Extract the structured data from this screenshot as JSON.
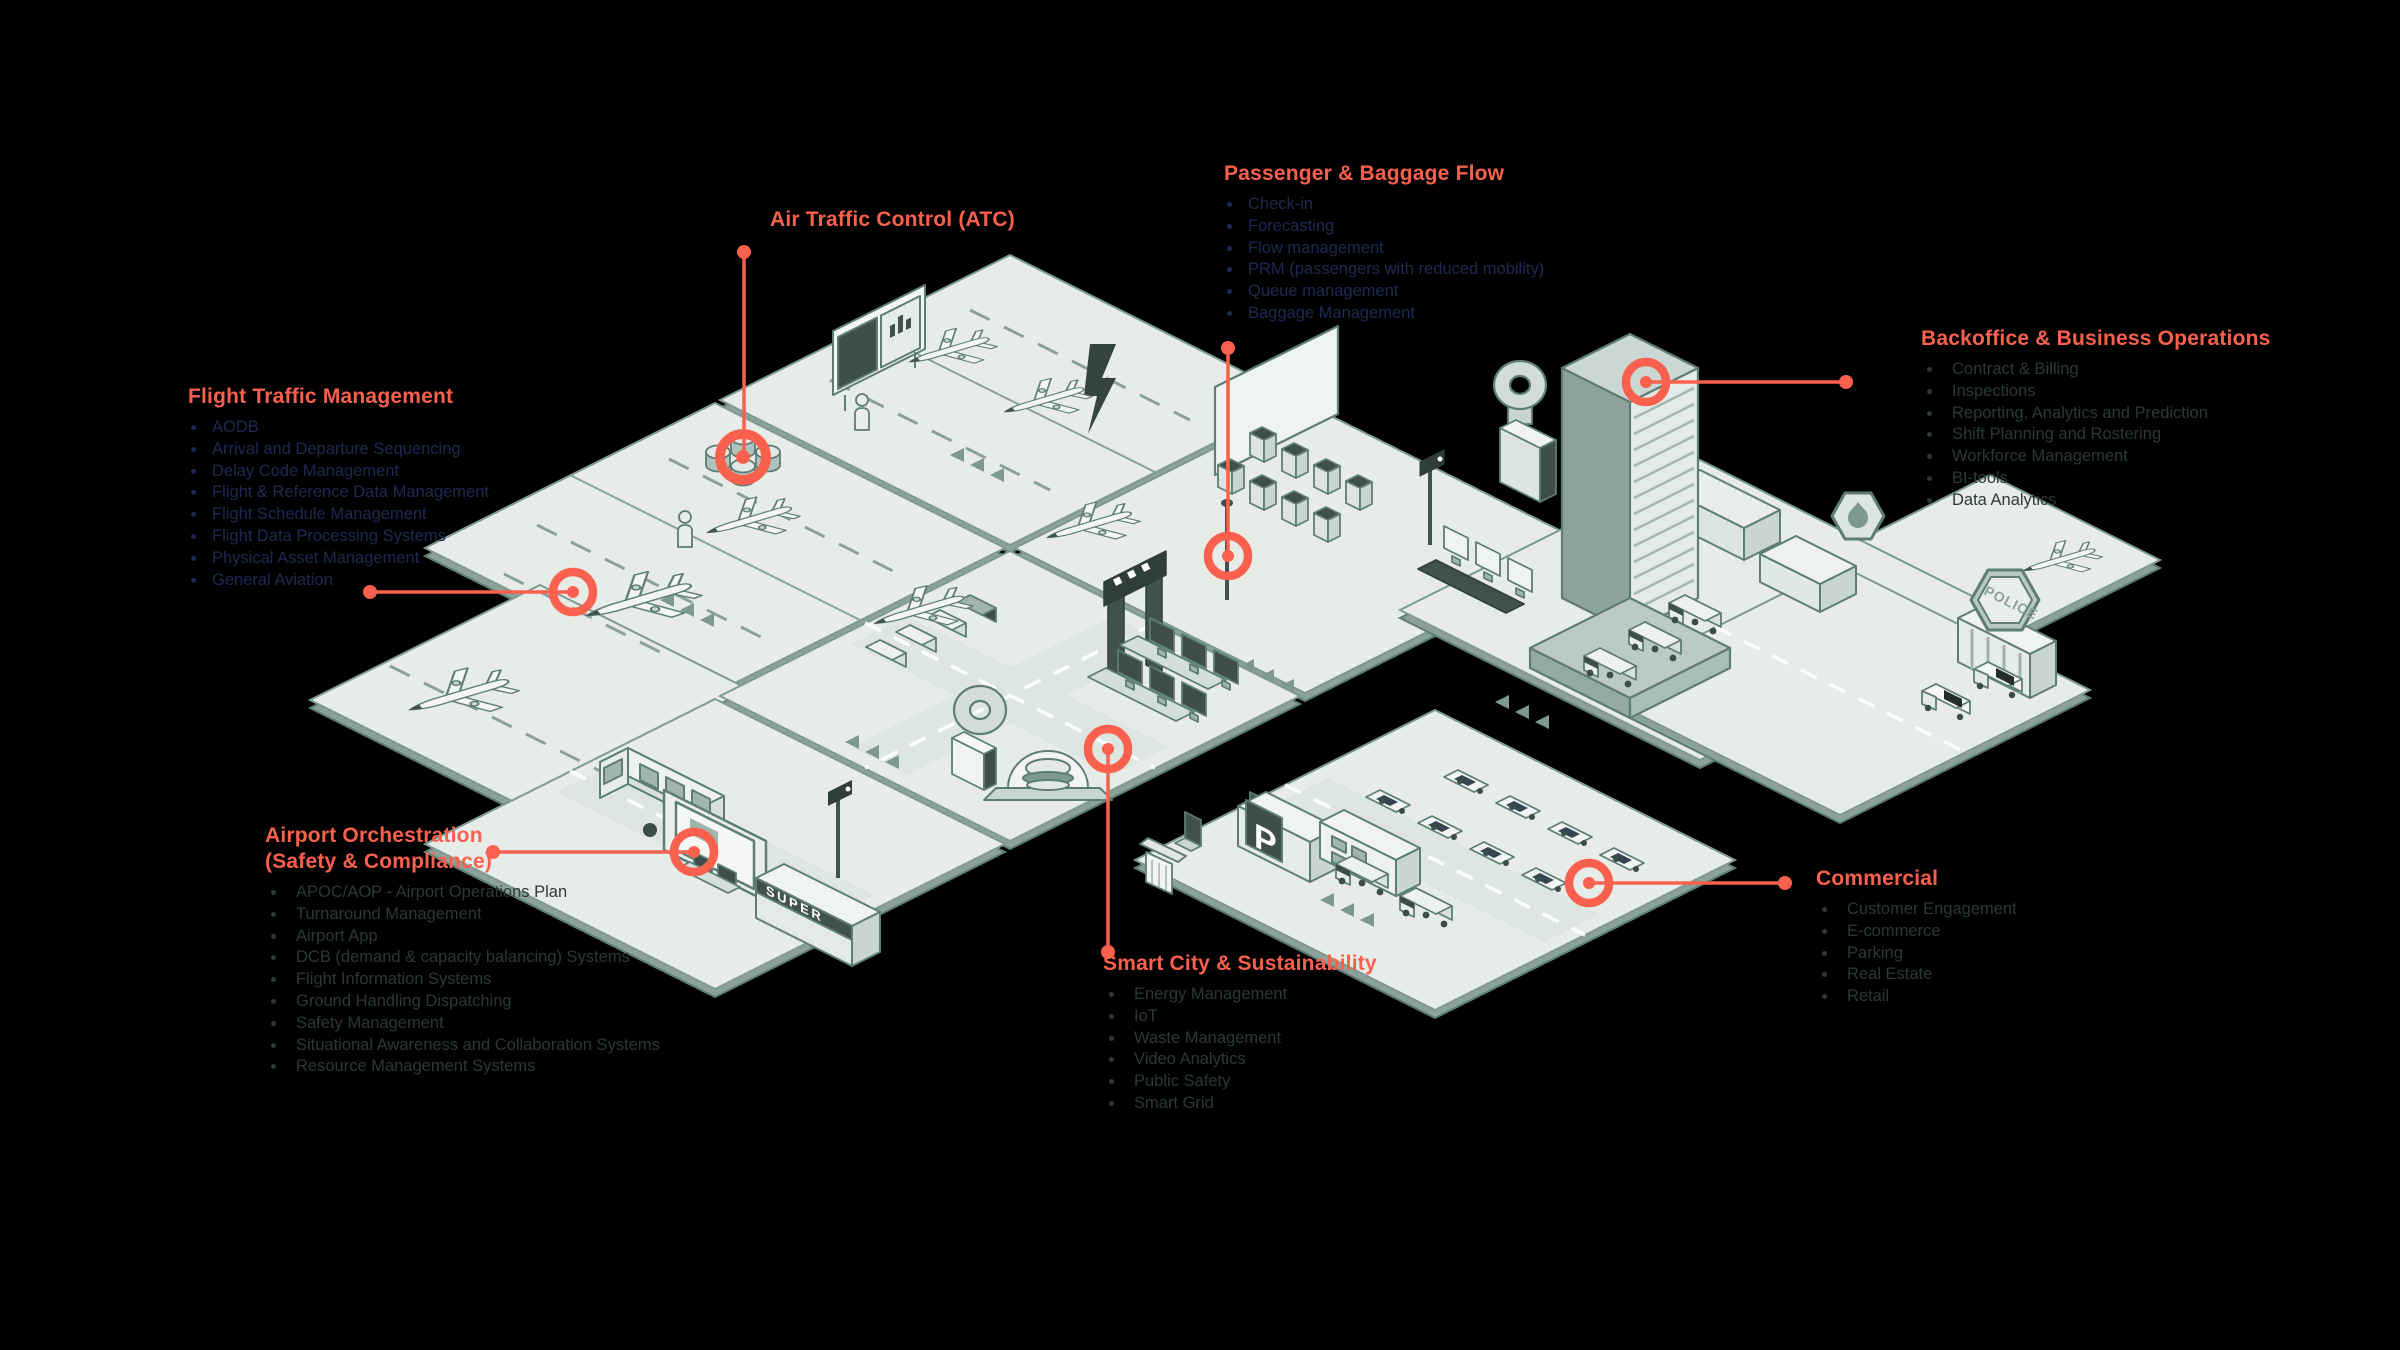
{
  "colors": {
    "accent": "#F9614E",
    "navy": "#1E2A52",
    "slate": "#2C3936"
  },
  "illustration": {
    "super_sign": "SUPER",
    "police_sign": "POLICE",
    "parking_sign": "P"
  },
  "callouts": {
    "flight_traffic_management": {
      "title": "Flight Traffic Management",
      "items": [
        "AODB",
        "Arrival and Departure Sequencing",
        "Delay Code Management",
        "Flight & Reference Data Management",
        "Flight Schedule Management",
        "Flight Data Processing Systems",
        "Physical Asset Management",
        "General Aviation"
      ]
    },
    "air_traffic_control": {
      "title": "Air Traffic Control (ATC)",
      "items": []
    },
    "passenger_baggage_flow": {
      "title": "Passenger & Baggage Flow",
      "items": [
        "Check-in",
        "Forecasting",
        "Flow management",
        "PRM (passengers with reduced mobility)",
        "Queue management",
        "Baggage Management"
      ]
    },
    "backoffice_business_operations": {
      "title": "Backoffice & Business Operations",
      "items": [
        "Contract & Billing",
        "Inspections",
        "Reporting, Analytics and Prediction",
        "Shift Planning and Rostering",
        "Workforce Management",
        "BI-tools",
        "Data Analytics"
      ]
    },
    "airport_orchestration": {
      "title": "Airport Orchestration\n(Safety & Compliance)",
      "items": [
        "APOC/AOP - Airport Operations Plan",
        "Turnaround Management",
        "Airport App",
        "DCB (demand & capacity balancing) Systems",
        "Flight Information Systems",
        "Ground Handling Dispatching",
        "Safety Management",
        "Situational Awareness and Collaboration Systems",
        "Resource Management Systems"
      ]
    },
    "smart_city_sustainability": {
      "title": "Smart City & Sustainability",
      "items": [
        "Energy Management",
        "IoT",
        "Waste Management",
        "Video Analytics",
        "Public Safety",
        "Smart Grid"
      ]
    },
    "commercial": {
      "title": "Commercial",
      "items": [
        "Customer Engagement",
        "E-commerce",
        "Parking",
        "Real Estate",
        "Retail"
      ]
    }
  }
}
